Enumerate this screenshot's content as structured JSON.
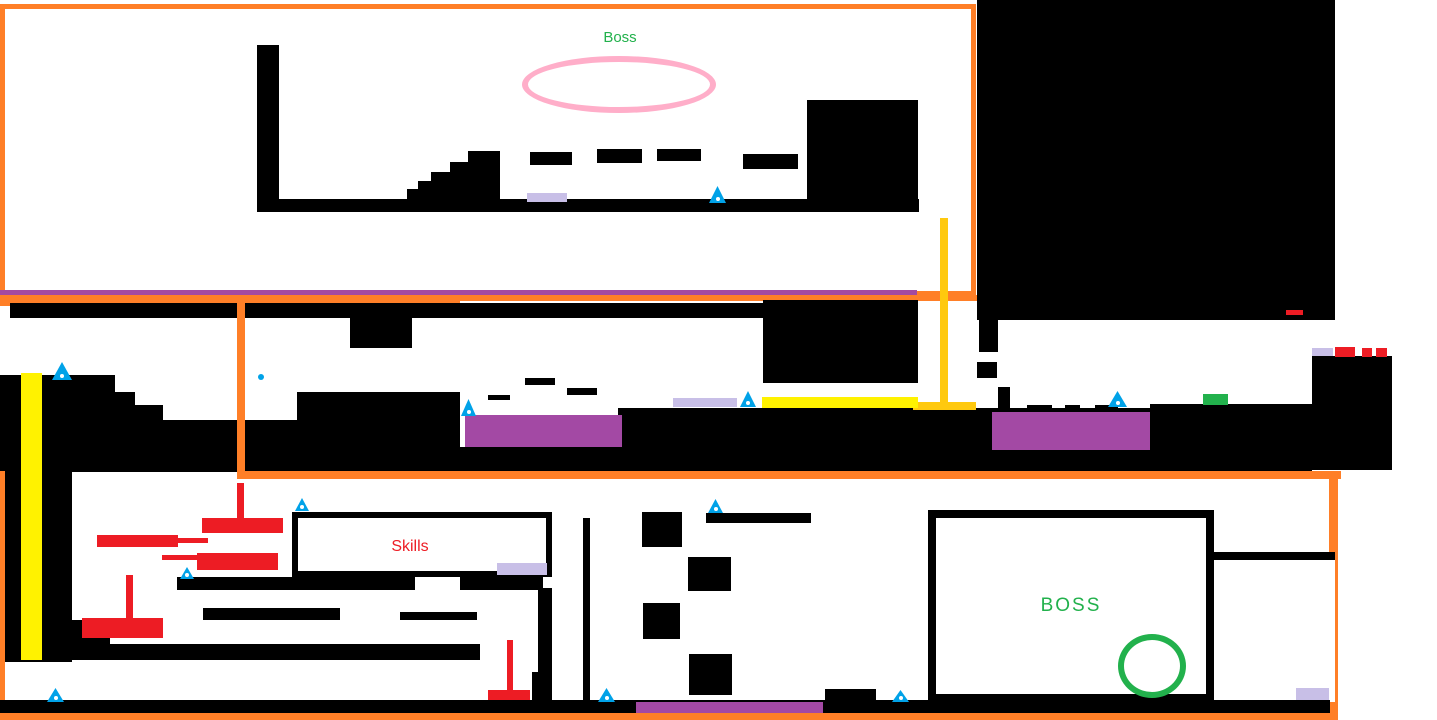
{
  "canvas": {
    "width": 1437,
    "height": 720,
    "background": "#FFFFFF",
    "description": "Hand-drawn platformer level design map"
  },
  "labels": {
    "top_boss_area": "Boss",
    "skills_room": "Skills",
    "bottom_boss_room": "BOSS"
  },
  "colors": {
    "black": "#000000",
    "orange": "#FF7F27",
    "magenta": "#A44AA0",
    "pink": "#FFAEC9",
    "purple": "#A349A4",
    "lavender": "#C8BFE7",
    "yellow": "#FFF200",
    "gold": "#FFC90E",
    "blue": "#00A2E8",
    "green": "#22B14C",
    "red": "#ED1C24",
    "white": "#FFFFFF"
  },
  "markers": {
    "blue_triangle_count": 11,
    "lavender_pad_count": 5,
    "boss_spawn_rings": 2
  }
}
